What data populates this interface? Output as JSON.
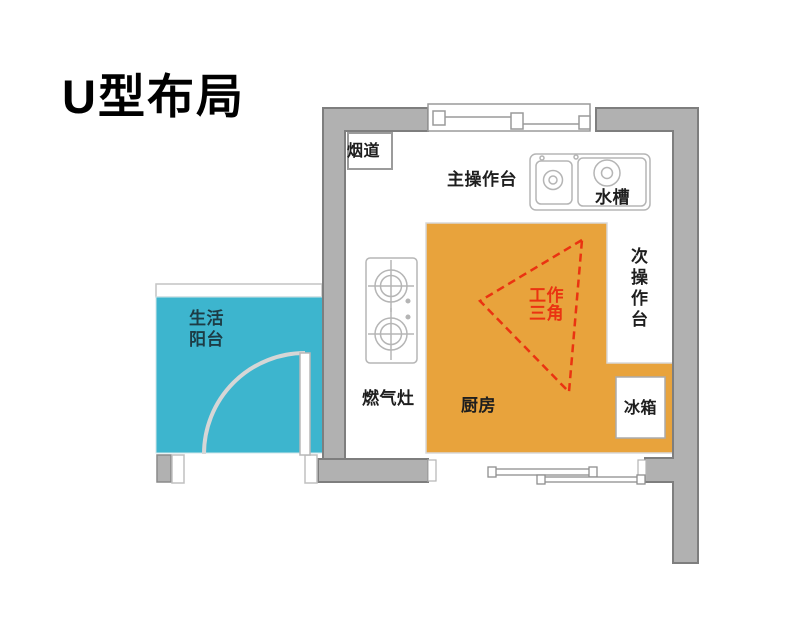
{
  "title": "U型布局",
  "labels": {
    "flue": "烟道",
    "main_counter": "主操作台",
    "sink": "水槽",
    "secondary_counter": "次操作台",
    "gas_stove": "燃气灶",
    "kitchen": "厨房",
    "fridge": "冰箱",
    "balcony": "生活阳台",
    "work_triangle": "工作三角"
  },
  "colors": {
    "kitchen_floor": "#E8A33C",
    "balcony_floor": "#3DB5CE",
    "wall_fill": "#B1B1B1",
    "wall_outline": "#7E7E7E",
    "fixture_outline": "#B5B5B5",
    "work_triangle": "#EA3311"
  }
}
